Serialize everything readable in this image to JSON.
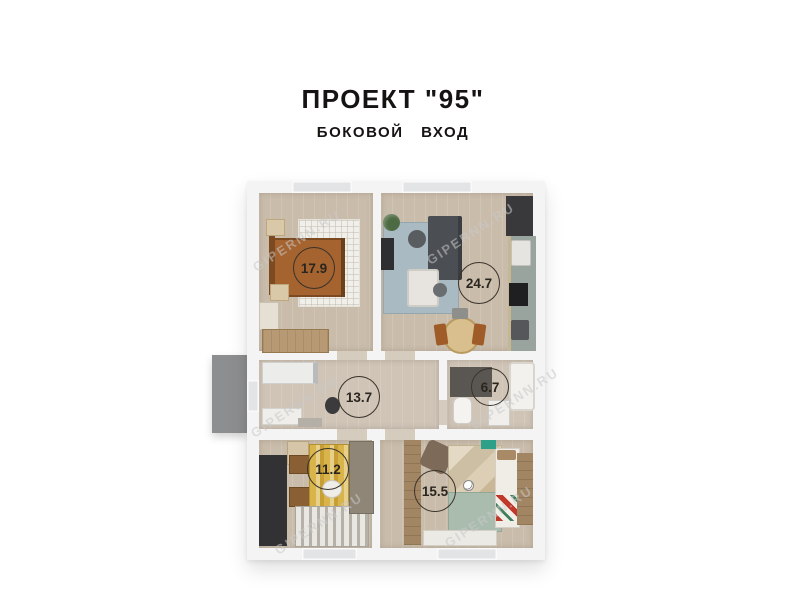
{
  "header": {
    "title": "ПРОЕКТ \"95\"",
    "subtitle": "БОКОВОЙ ВХОД"
  },
  "watermark": {
    "text": "GIPERNN.RU"
  },
  "floorplan": {
    "rooms": [
      {
        "name": "bedroom",
        "area": "17.9"
      },
      {
        "name": "living-kitchen",
        "area": "24.7"
      },
      {
        "name": "hallway",
        "area": "13.7"
      },
      {
        "name": "bathroom",
        "area": "6.7"
      },
      {
        "name": "office",
        "area": "11.2"
      },
      {
        "name": "kids-bedroom",
        "area": "15.5"
      }
    ],
    "colors": {
      "wall": "#f4f4f5",
      "floor": "#c9bcab",
      "porch": "#8c8e8f",
      "rug_blue": "#a9bac3",
      "rug_yellow": "#d2a93c",
      "rug_green": "#a9bcae",
      "bed_wood": "#a4632f",
      "kitchen_dark": "#39393b"
    }
  }
}
